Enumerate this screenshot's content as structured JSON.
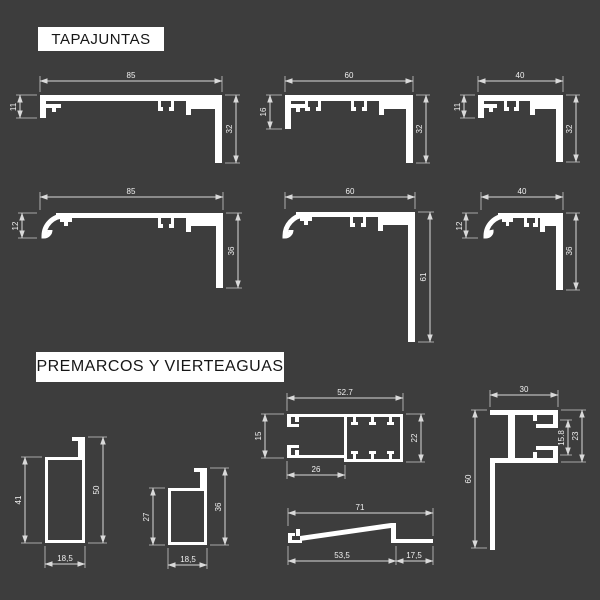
{
  "page": {
    "bg_color": "#3d3d3d",
    "ink_color": "#ffffff",
    "dim_line_color": "#d9d9d9"
  },
  "sections": {
    "tapajuntas": {
      "label": "TAPAJUNTAS"
    },
    "premarcos": {
      "label": "PREMARCOS Y VIERTEAGUAS"
    }
  },
  "profiles": {
    "flat85": {
      "width": "85",
      "left_height": "11",
      "leg_height": "32"
    },
    "flat60": {
      "width": "60",
      "left_height": "16",
      "leg_height": "32"
    },
    "flat40": {
      "width": "40",
      "left_height": "11",
      "leg_height": "32"
    },
    "curved85": {
      "width": "85",
      "left_height": "12",
      "leg_height": "36"
    },
    "curved60": {
      "width": "60",
      "leg_height": "61"
    },
    "curved40": {
      "width": "40",
      "left_height": "12",
      "leg_height": "36"
    },
    "premarco50": {
      "left_height": "41",
      "right_height": "50",
      "bottom_width": "18,5"
    },
    "premarco36": {
      "left_height": "27",
      "right_height": "36",
      "bottom_width": "18,5"
    },
    "box527": {
      "top_width": "52.7",
      "left_height": "15",
      "right_height": "22",
      "bottom_width": "26"
    },
    "angle30": {
      "top_width": "30",
      "left_height": "60",
      "right_inner": "15.8",
      "right_outer": "23"
    },
    "vierteaguas71": {
      "top_width": "71",
      "bottom_left": "53,5",
      "bottom_right": "17,5"
    }
  }
}
